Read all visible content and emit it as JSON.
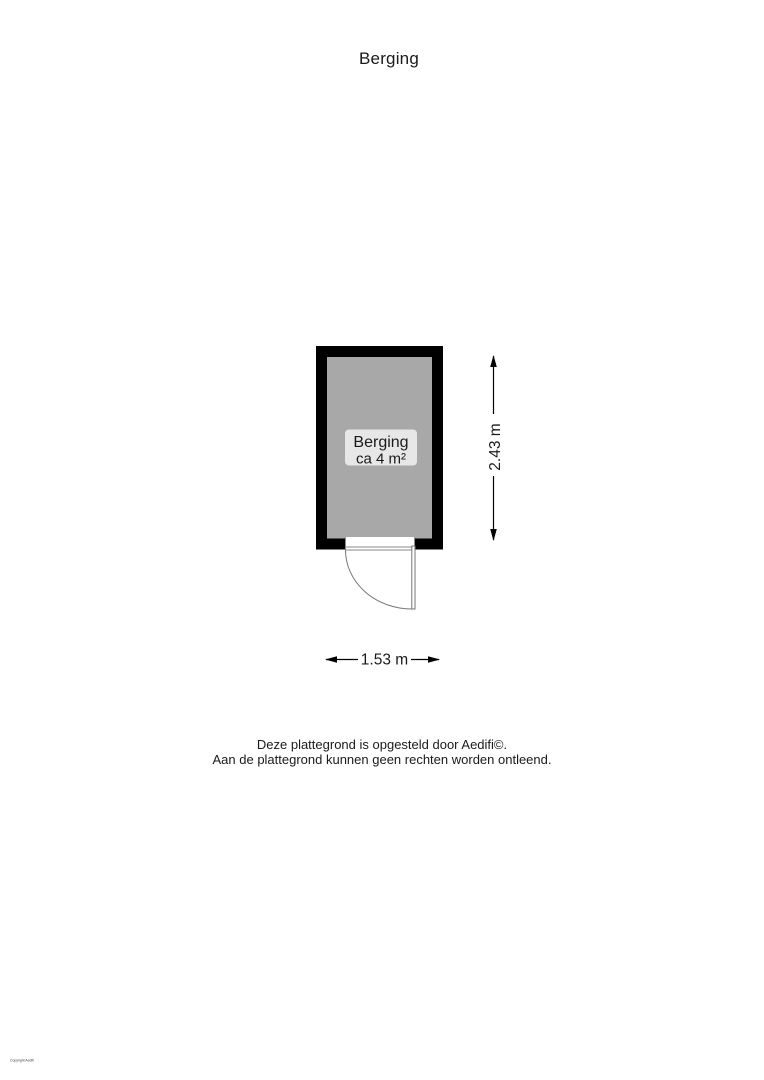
{
  "page": {
    "title": "Berging"
  },
  "floorplan": {
    "room_label": {
      "name": "Berging",
      "area": "ca 4 m²"
    },
    "dim_height": "2.43 m",
    "dim_width": "1.53 m",
    "colors": {
      "wall": "#000000",
      "floor": "#a8a8a8",
      "label_bg": "#e7e7e7",
      "door_line": "#777777",
      "dim_line": "#000000"
    }
  },
  "footer": {
    "line1": "Deze plattegrond is opgesteld door Aedifi©.",
    "line2": "Aan de plattegrond kunnen geen rechten worden ontleend."
  },
  "watermark": "Copyright Aedifi"
}
